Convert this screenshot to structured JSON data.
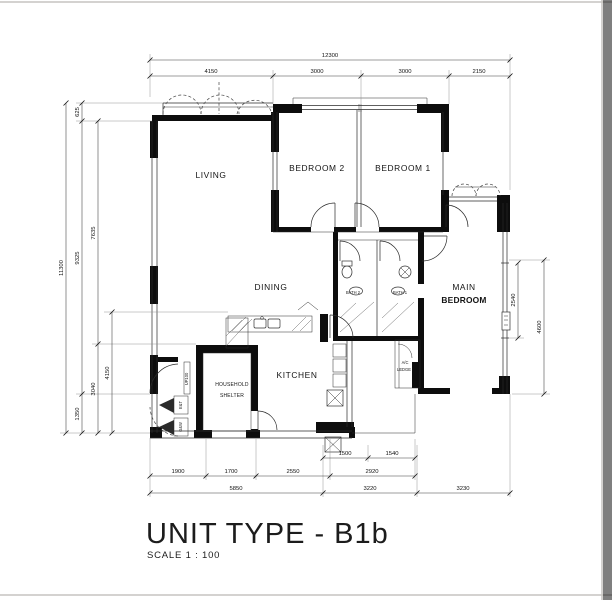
{
  "title": {
    "main": "UNIT TYPE - B1b",
    "scale": "SCALE   1 : 100"
  },
  "rooms": {
    "living": "LIVING",
    "bedroom2": "BEDROOM 2",
    "bedroom1": "BEDROOM 1",
    "main_bedroom_line1": "MAIN",
    "main_bedroom_line2": "BEDROOM",
    "dining": "DINING",
    "kitchen": "KITCHEN",
    "household_shelter_line1": "HOUSEHOLD",
    "household_shelter_line2": "SHELTER",
    "bath2": "BATH 2",
    "bath1": "BATH 1",
    "ac_ledge_line1": "A/C",
    "ac_ledge_line2": "LEDGE"
  },
  "annotations": {
    "step": "UP100",
    "duct_top": "E&T",
    "duct_bottom": "G&W"
  },
  "dimensions": {
    "top_total": "12300",
    "top": [
      "4150",
      "3000",
      "3000",
      "2150"
    ],
    "left_total": "11300",
    "left_outer": [
      "625",
      "9325",
      "1350"
    ],
    "left_mid": [
      "7635",
      "3040"
    ],
    "left_inner": [
      "4150"
    ],
    "right": [
      "2540",
      "4600"
    ],
    "bottom_row1": [
      "1500",
      "1540"
    ],
    "bottom_row2": [
      "1900",
      "1700",
      "2550",
      "2920"
    ],
    "bottom_row3": [
      "5850",
      "3220",
      "3230"
    ]
  }
}
